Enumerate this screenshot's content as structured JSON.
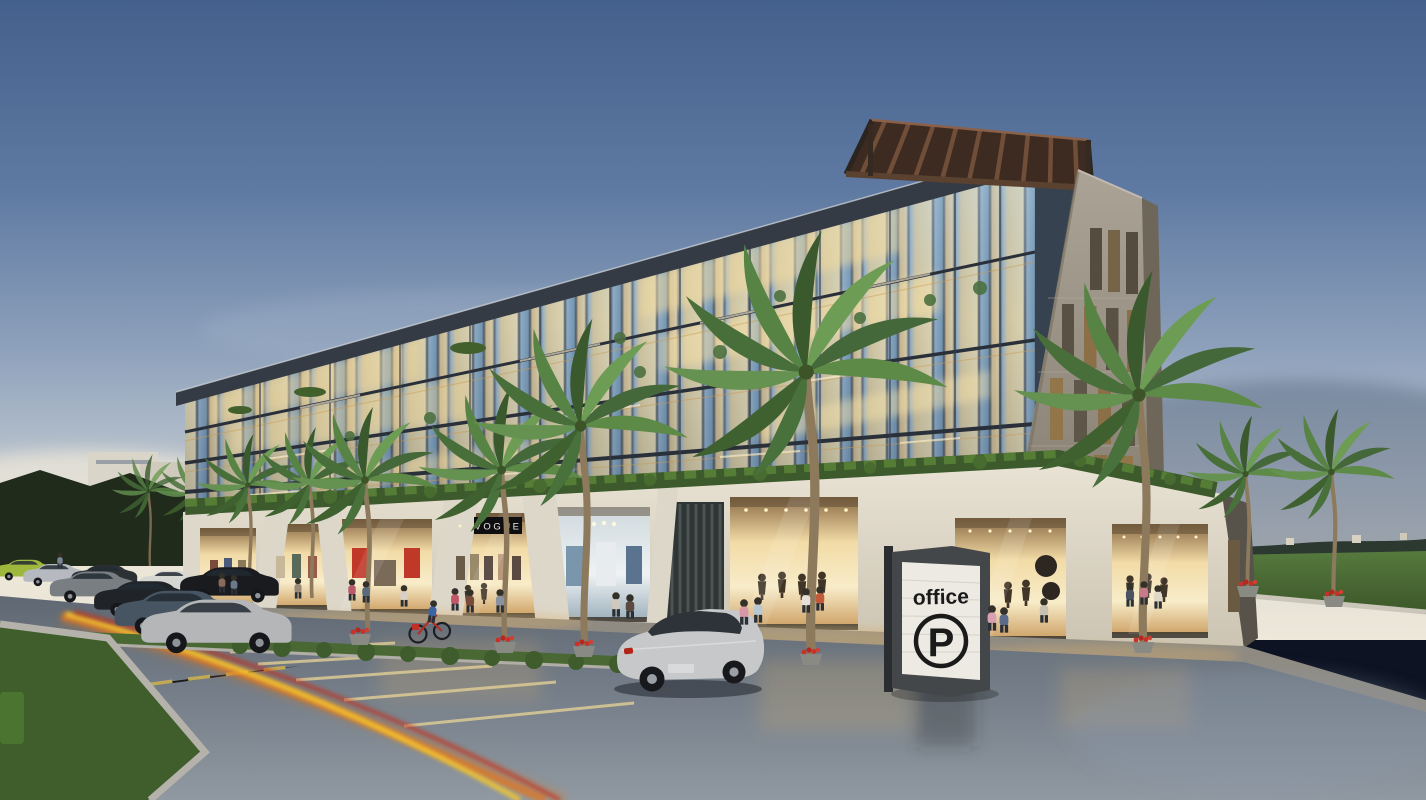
{
  "scene": {
    "type": "3d architectural rendering",
    "subject": "Modern glass office building with ground-floor retail at dusk",
    "setting": "street corner with parking lane, palm trees and lawns"
  },
  "signs": {
    "parking_sign": {
      "line1": "office",
      "symbol": "P"
    },
    "store_sign": {
      "text": "VOGUE"
    }
  },
  "building": {
    "glass_floors": 3,
    "ground_floor": "retail storefronts with warm illuminated display windows",
    "corner_feature": "stone tower with vertical slot windows",
    "roof_feature": "timber pergola canopy",
    "podium_planting": "trimmed hedge band above the storefronts"
  },
  "vehicles": {
    "foreground_car": "silver coupe",
    "parked_row": [
      "lime green sports car",
      "silver sedan",
      "dark grey sedan",
      "white hatchback",
      "grey SUV",
      "black limousine",
      "black coupe",
      "dark blue sedan",
      "large silver sedan"
    ]
  },
  "vegetation": {
    "palm_trees": 12,
    "hedges": true,
    "lawns": true
  },
  "people": {
    "pedestrians": 21,
    "cyclists": 1
  },
  "road": {
    "surface": "wet reflective asphalt",
    "markings": "pale yellow parking bays and dashed edge line",
    "light_trails": [
      "yellow",
      "orange",
      "red"
    ]
  },
  "palette": {
    "skyTop": "#44608c",
    "skyHorizon": "#ede8da",
    "glassWarm": "#f2dba6",
    "glassCool": "#7396b2",
    "stone": "#a09a8d",
    "podium": "#e2dccf",
    "hedge": "#3c5a2b",
    "lawn": "#3f5e2b",
    "road": "#6b747f",
    "trailYellow": "#f6c82e",
    "trailOrange": "#e2761c",
    "trailRed": "#c62a12",
    "signFrame": "#43474a",
    "signPanel": "#eceae2",
    "signText": "#1a1a1a",
    "pergola": "#5a4130"
  }
}
